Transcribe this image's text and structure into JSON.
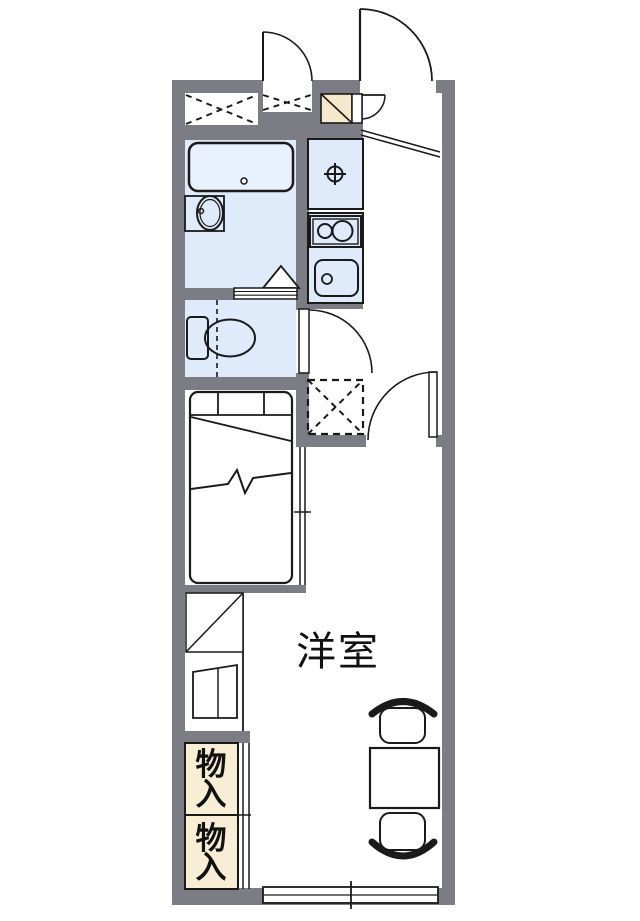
{
  "plan": {
    "type": "apartment-floor-plan",
    "rooms": {
      "main_room_label": "洋室",
      "storage_top_label": "物入",
      "storage_bottom_label": "物入"
    },
    "colors": {
      "background": "#ffffff",
      "wall": "#7c7c84",
      "wet_area": "#dfeafa",
      "bathtub_fill": "#e9f1fc",
      "storage_fill": "#f8eed6",
      "shoe_box_fill": "#f6e8cb",
      "line": "#1a1a1a"
    },
    "fixtures": [
      "bathtub",
      "washbasin",
      "shower-triangle",
      "toilet",
      "washing-machine-pan",
      "gas-stove",
      "kitchen-sink",
      "refrigerator-space",
      "shoe-cabinet",
      "bed",
      "partition-window",
      "storage-closet",
      "mini-fridge",
      "table",
      "chair",
      "entrance-door",
      "room-door",
      "window"
    ]
  }
}
